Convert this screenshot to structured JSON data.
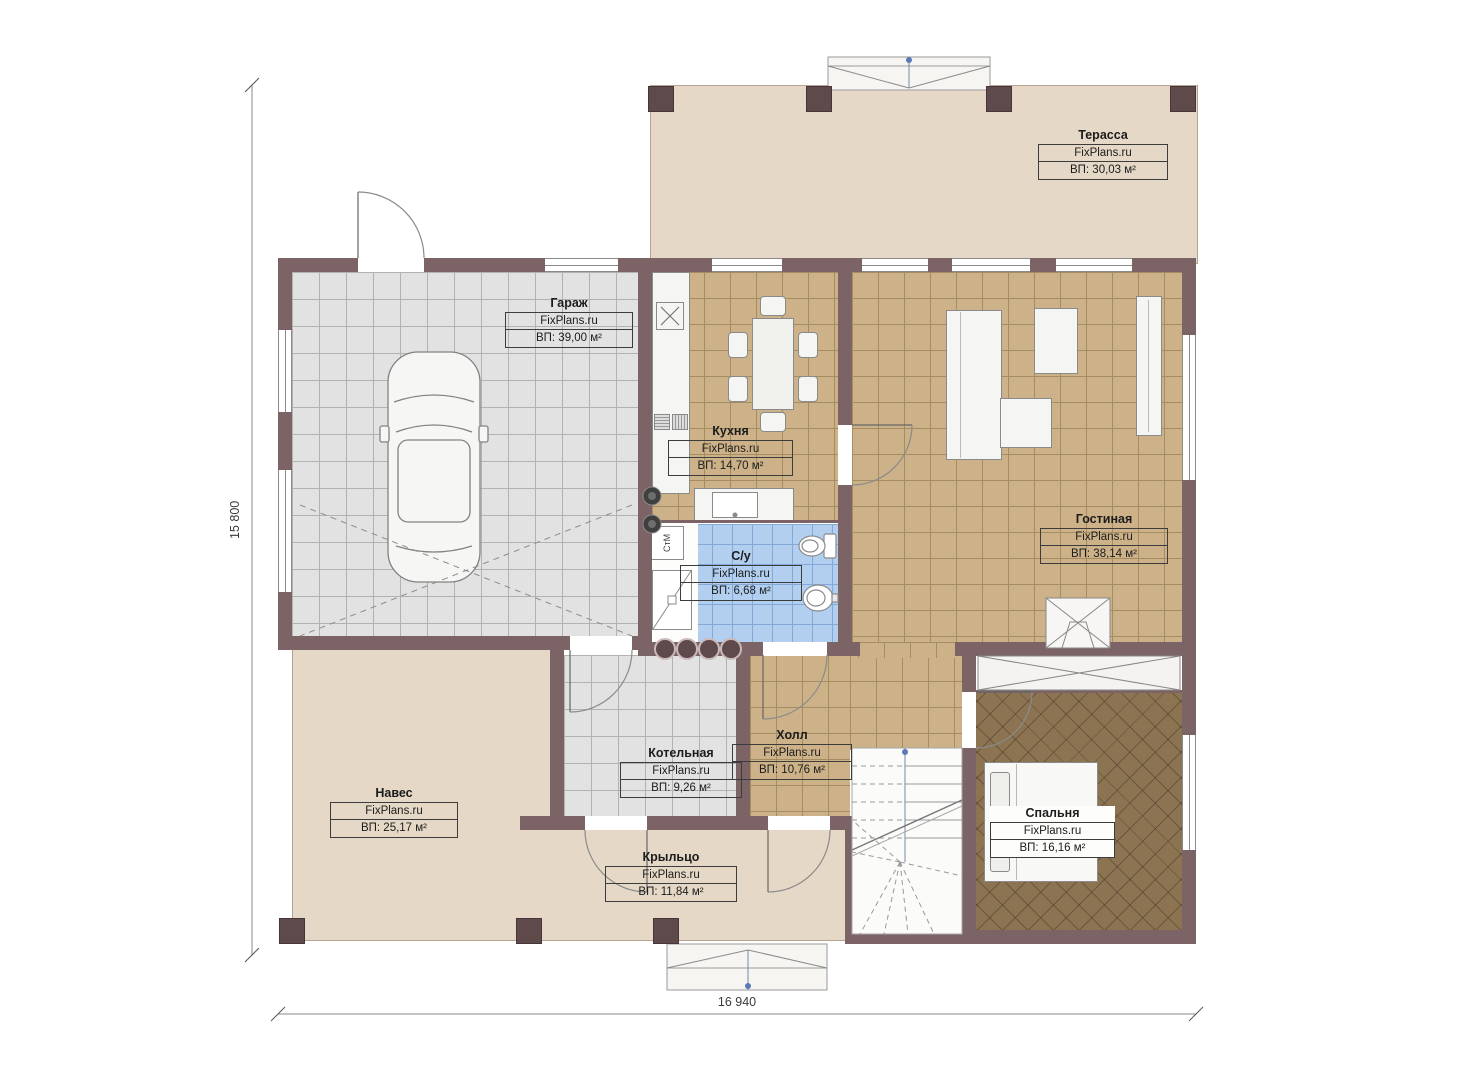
{
  "plan": {
    "watermark": "FixPlans.ru",
    "dimensions": {
      "height_label": "15 800",
      "width_label": "16 940"
    },
    "rooms": [
      {
        "id": "terrace",
        "name": "Терасса",
        "area": "ВП: 30,03 м²"
      },
      {
        "id": "garage",
        "name": "Гараж",
        "area": "ВП: 39,00 м²"
      },
      {
        "id": "kitchen",
        "name": "Кухня",
        "area": "ВП: 14,70 м²"
      },
      {
        "id": "living",
        "name": "Гостиная",
        "area": "ВП: 38,14 м²"
      },
      {
        "id": "bathroom",
        "name": "С/у",
        "area": "ВП: 6,68 м²"
      },
      {
        "id": "boiler",
        "name": "Котельная",
        "area": "ВП: 9,26 м²"
      },
      {
        "id": "hall",
        "name": "Холл",
        "area": "ВП: 10,76 м²"
      },
      {
        "id": "canopy",
        "name": "Навес",
        "area": "ВП: 25,17 м²"
      },
      {
        "id": "porch",
        "name": "Крыльцо",
        "area": "ВП: 11,84 м²"
      },
      {
        "id": "bedroom",
        "name": "Спальня",
        "area": "ВП: 16,16 м²"
      }
    ],
    "labels": {
      "washing_machine": "СтМ"
    },
    "colors": {
      "wall": "#7c6466",
      "column": "#5e494b",
      "terrace_floor": "#e6d8c6",
      "tile_tan": "#cdb289",
      "tile_gray": "#e2e2e2",
      "tile_blue": "#b2cff0",
      "bedroom_floor": "#8c7453",
      "marker_blue": "#5b79b5"
    }
  }
}
